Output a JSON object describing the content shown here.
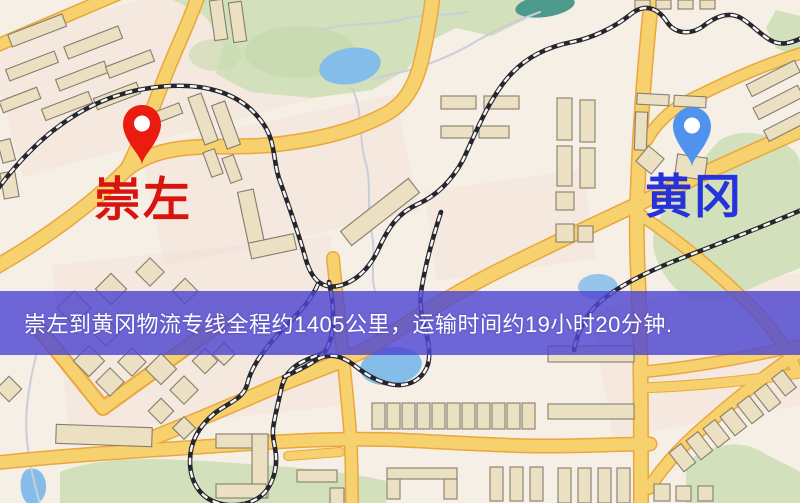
{
  "banner": {
    "text": "崇左到黄冈物流专线全程约1405公里，运输时间约19小时20分钟.",
    "background_color": "rgba(79,71,210,0.82)",
    "text_color": "#ffffff"
  },
  "markers": {
    "origin": {
      "label": "崇左",
      "label_color": "#d9140f",
      "pin_color": "#ec1b10"
    },
    "destination": {
      "label": "黄冈",
      "label_color": "#2433da",
      "pin_color": "#4f93ee"
    }
  },
  "map_palette": {
    "background": "#f6efe6",
    "road_fill": "#f5d170",
    "road_casing": "#e9a73f",
    "park_green": "#d2e0bd",
    "water_blue": "#85bde8",
    "teal_pond": "#4e9a8c",
    "building_fill": "#ebe0c2",
    "building_outline": "#857d6e",
    "railway_dark": "#26262e",
    "banner_overlay": "rgba(79,71,210,0.82)"
  }
}
